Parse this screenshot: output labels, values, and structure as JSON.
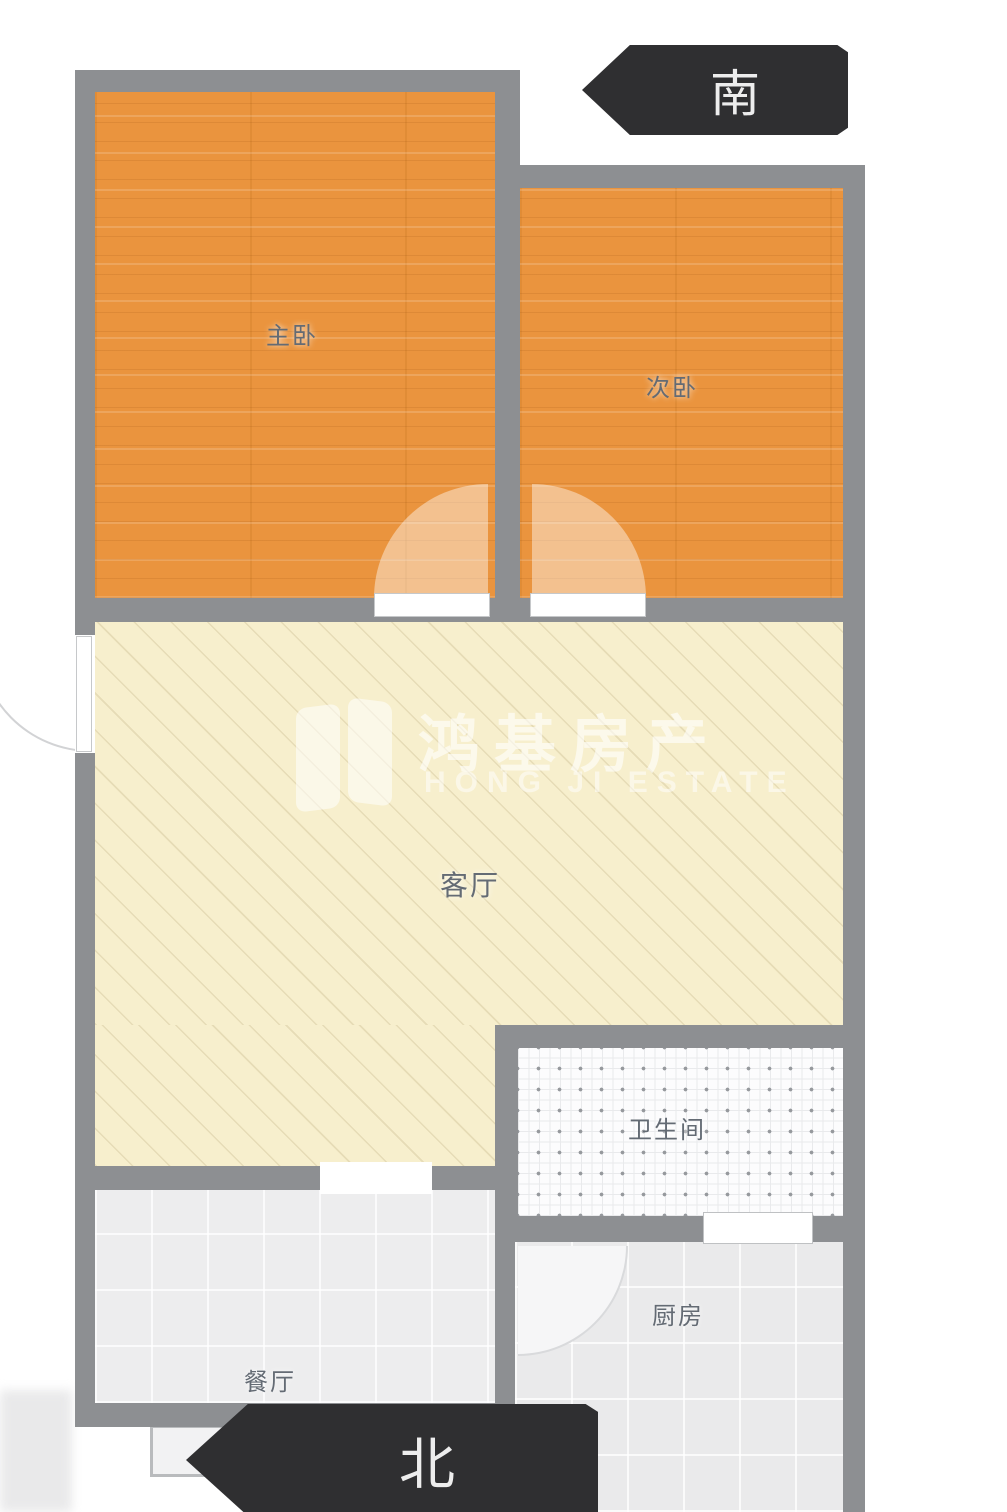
{
  "title": "apartment-floor-plan",
  "compass": {
    "south": "南",
    "north": "北"
  },
  "rooms": {
    "master": {
      "label": "主卧"
    },
    "second": {
      "label": "次卧"
    },
    "living": {
      "label": "客厅"
    },
    "bath": {
      "label": "卫生间"
    },
    "kitchen": {
      "label": "厨房"
    },
    "dining": {
      "label": "餐厅"
    }
  },
  "watermark": {
    "cn": "鸿基房产",
    "en": "HONG JI ESTATE"
  },
  "colors": {
    "wall": "#8d8f92",
    "wood": "#ea943e",
    "living": "#f7efcd",
    "tile": "#eaeaeb",
    "bath": "#fcfcfd",
    "arrow": "#2f2f31",
    "label": "#646b74"
  }
}
